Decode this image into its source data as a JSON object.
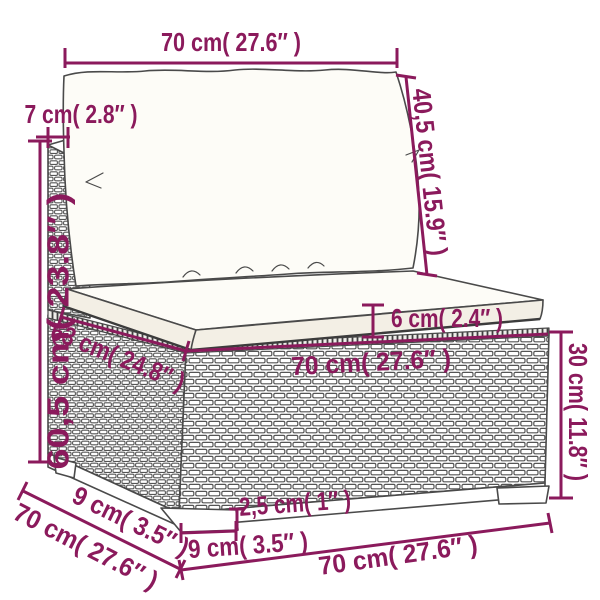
{
  "colors": {
    "accent": "#8b1a5c",
    "outline": "#4a4a4a",
    "background": "#ffffff",
    "cushion_top": "#fdfcf7",
    "cushion_side": "#f3efe5",
    "shadow": "#3c3c3c"
  },
  "measurements": {
    "back_width": "70 cm( 27.6″ )",
    "back_height": "40,5 cm( 15.9″ )",
    "back_thickness": "7 cm( 2.8″ )",
    "total_height": "60,5 cm( 23.8″ )",
    "seat_depth": "63 cm( 24.8″ )",
    "cushion_thickness": "6 cm( 2.4″ )",
    "seat_width": "70 cm( 27.6″ )",
    "base_height": "30 cm( 11.8″ )",
    "side_offset": "9 cm( 3.5″ )",
    "side_depth": "70 cm( 27.6″ )",
    "leg_width": "9 cm( 3.5″ )",
    "leg_height": "2,5 cm( 1″ )",
    "front_width": "70 cm( 27.6″ )"
  }
}
